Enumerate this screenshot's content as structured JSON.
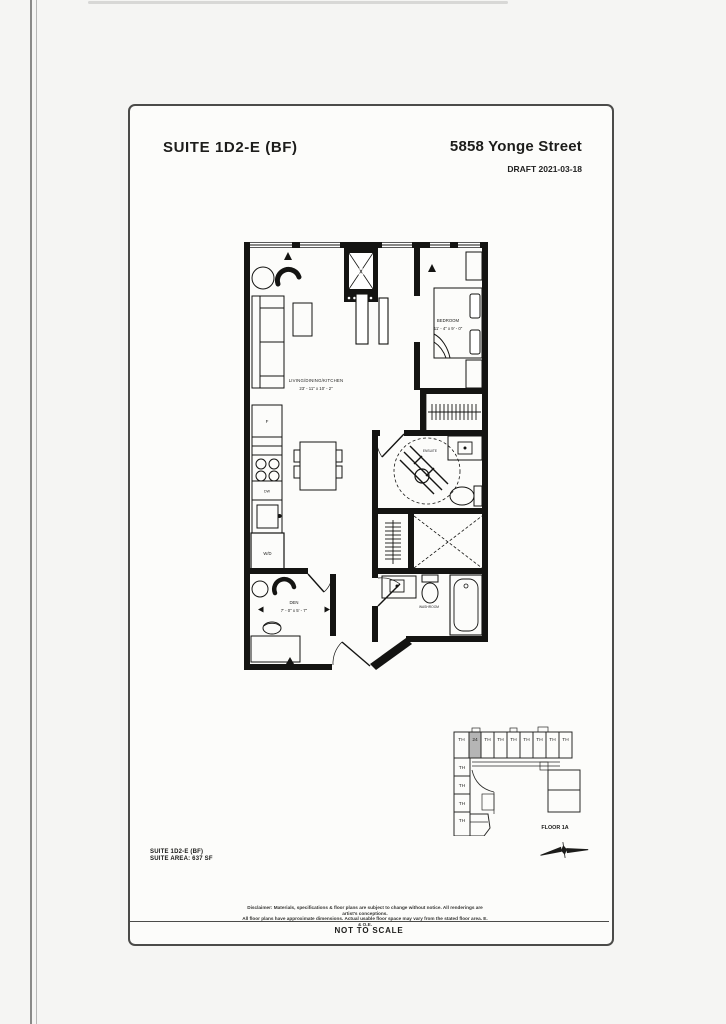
{
  "header": {
    "suite_title": "SUITE  1D2-E (BF)",
    "address": "5858 Yonge Street",
    "draft_label": "DRAFT 2021-03-18"
  },
  "floorplan": {
    "living": {
      "label": "LIVING/DINING/KITCHEN",
      "dims": "23' - 11\" x 10' - 2\""
    },
    "bedroom": {
      "label": "BEDROOM",
      "dims": "11' - 4\" x 9' - 0\""
    },
    "den": {
      "label": "DEN",
      "dims": "7' - 0\" x 5' - 7\""
    },
    "ensuite_label": "ENSUITE",
    "washroom_label": "WASHROOM",
    "fridge_label": "F",
    "dishwasher_label": "DW",
    "washer_dryer_label": "W/D",
    "shaft_label": "X"
  },
  "keyplan": {
    "floor_label": "FLOOR 1A",
    "top_units": [
      "TH",
      "24",
      "TH",
      "TH",
      "TH",
      "TH",
      "TH",
      "TH",
      "TH"
    ],
    "left_units": [
      "TH",
      "TH",
      "TH",
      "TH"
    ],
    "highlighted_unit": "24",
    "highlight_color": "#b5b5b5"
  },
  "suite_info": {
    "line1": "SUITE 1D2-E (BF)",
    "line2": "SUITE AREA: 637 SF"
  },
  "disclaimer": {
    "line1": "Disclaimer: Materials, specifications & floor plans are subject to change without notice. All renderings are artist's conceptions.",
    "line2": "All floor plans have approximate dimensions. Actual usable floor space may vary from the stated floor area. E. & O.E."
  },
  "footer": {
    "not_to_scale": "NOT TO SCALE"
  }
}
